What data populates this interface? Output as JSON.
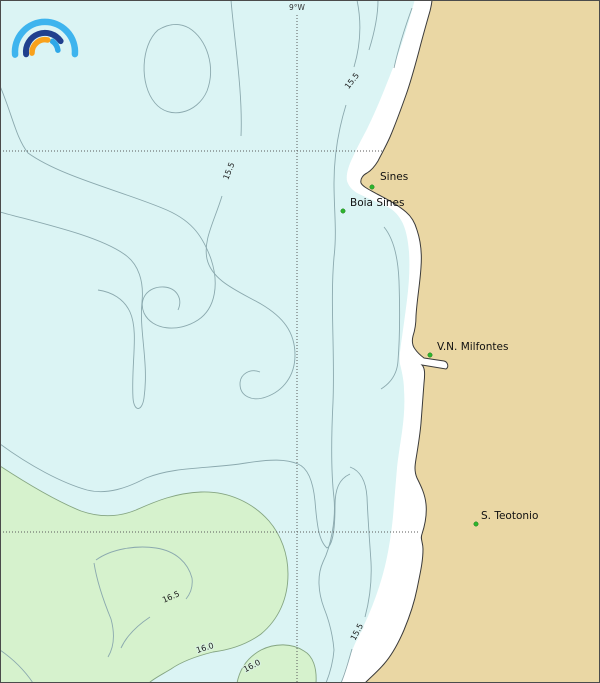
{
  "logo": {
    "name": "meteoblue rainbow logo",
    "colors": {
      "outer": "#3EB4EE",
      "middle": "#20408E",
      "inner_tail": "#2FA8E8",
      "orange": "#F9A11B"
    }
  },
  "graticule": {
    "meridian_label": "9°W"
  },
  "places": [
    {
      "label": "Sines",
      "marker": "green-dot"
    },
    {
      "label": "Boia Sines",
      "marker": "green-dot"
    },
    {
      "label": "V.N. Milfontes",
      "marker": "green-dot"
    },
    {
      "label": "S. Teotonio",
      "marker": "green-dot"
    }
  ],
  "contour_labels": [
    {
      "text": "15.5"
    },
    {
      "text": "15.5"
    },
    {
      "text": "15.5"
    },
    {
      "text": "16.5"
    },
    {
      "text": "16.0"
    },
    {
      "text": "16.0"
    }
  ],
  "contour_values": [
    15.5,
    16.0,
    16.5
  ],
  "colors": {
    "sea": "#DBF4F4",
    "land": "#EAD7A4",
    "warm_band": "#D6F2CD",
    "marker": "#2DB52D",
    "coastline": "#3A3A3A",
    "contour": "#8BA9AE"
  }
}
